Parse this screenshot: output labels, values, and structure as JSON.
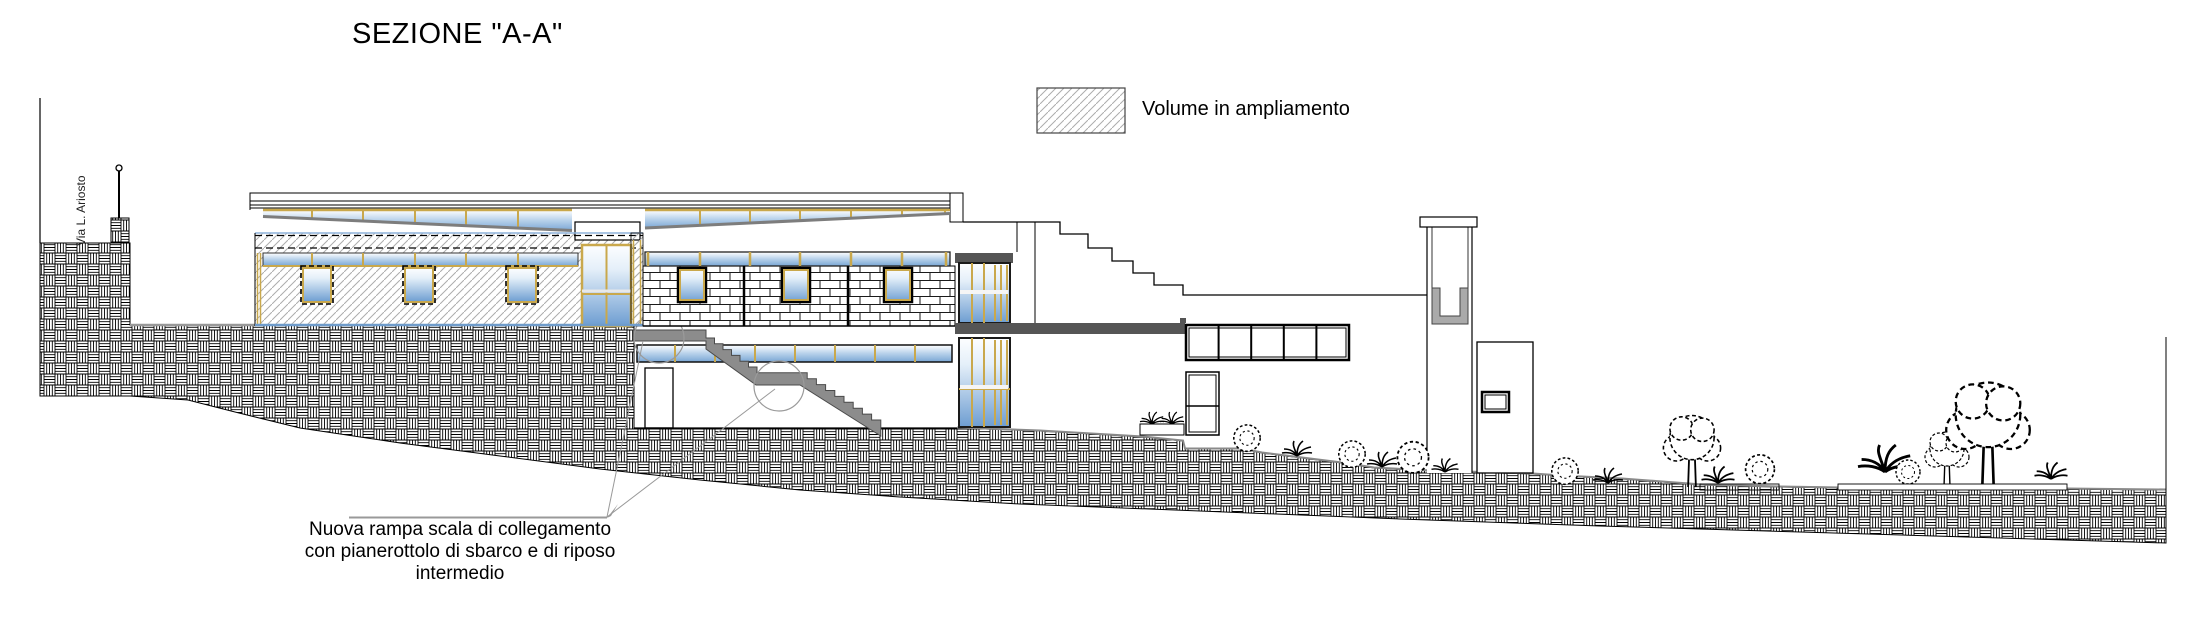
{
  "header": {
    "title": "SEZIONE \"A-A\""
  },
  "legend": {
    "label": "Volume in ampliamento",
    "swatch": "diagonal-hatch"
  },
  "street_label": "Via L. Ariosto",
  "annotation": {
    "line1": "Nuova rampa scala di collegamento",
    "line2": "con pianerottolo di sbarco e di riposo",
    "line3": "intermedio"
  },
  "colors": {
    "glass_blue": "#6d9dd1",
    "frame_gold": "#c9a84c",
    "slab_gray": "#555555",
    "stair_gray": "#8c8c8c",
    "hatch_gray": "#adadad",
    "leader_gray": "#999999",
    "ink": "#000000"
  }
}
